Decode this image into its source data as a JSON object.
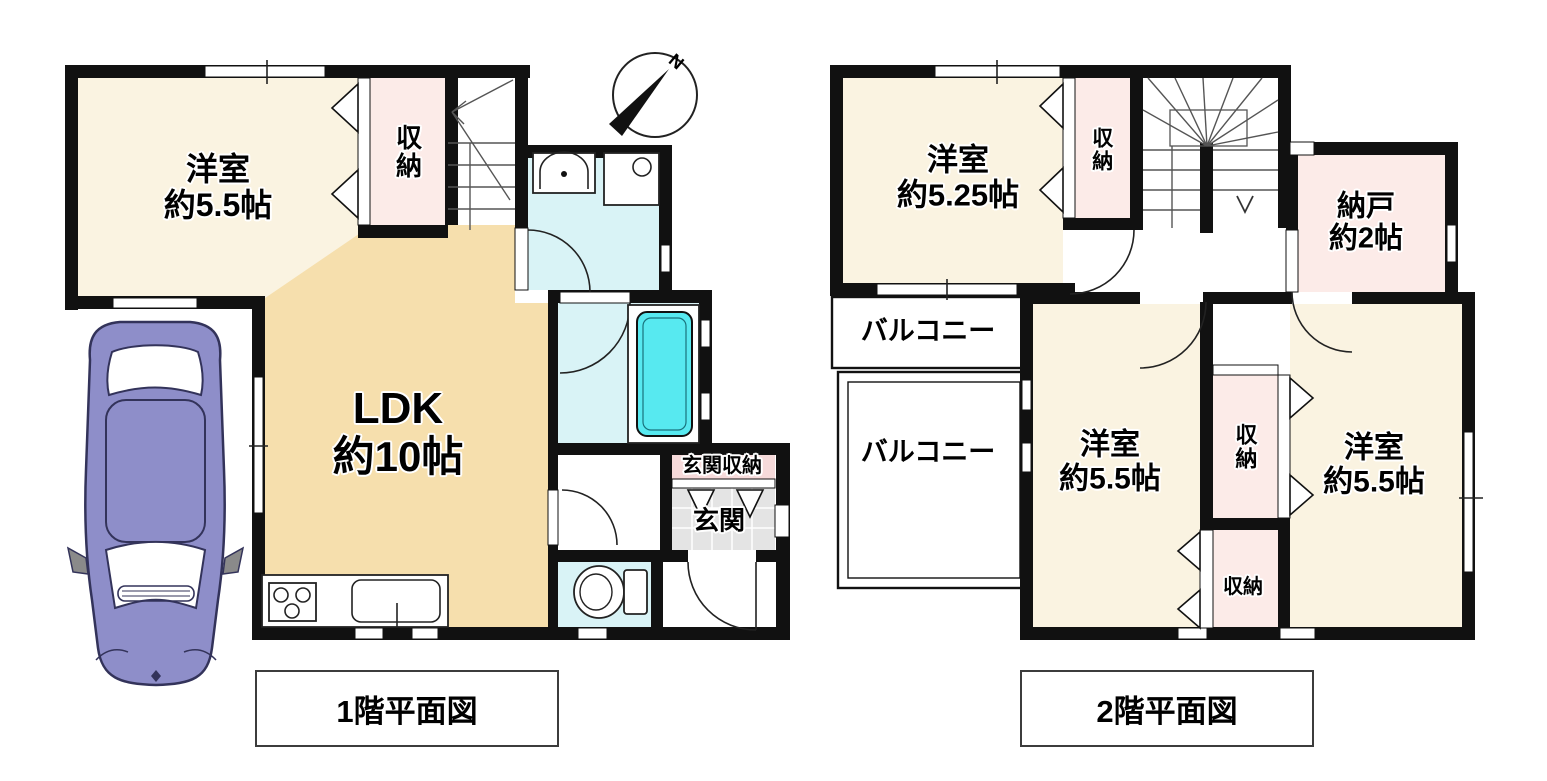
{
  "meta": {
    "type": "floor-plan",
    "width": 1547,
    "height": 781
  },
  "compass": {
    "north_label": "N"
  },
  "floor1": {
    "caption": "1階平面図",
    "rooms": {
      "western_room": {
        "name": "洋室",
        "size": "約5.5帖"
      },
      "ldk": {
        "name": "LDK",
        "size": "約10帖"
      },
      "closet": {
        "label": "収納"
      },
      "entrance_storage": {
        "label": "玄関収納"
      },
      "entrance": {
        "label": "玄関"
      }
    }
  },
  "floor2": {
    "caption": "2階平面図",
    "rooms": {
      "western_room_525": {
        "name": "洋室",
        "size": "約5.25帖"
      },
      "storeroom": {
        "name": "納戸",
        "size": "約2帖"
      },
      "closet_top": {
        "label": "収納"
      },
      "balcony_upper": {
        "label": "バルコニー"
      },
      "balcony_lower": {
        "label": "バルコニー"
      },
      "western_room_sw": {
        "name": "洋室",
        "size": "約5.5帖"
      },
      "western_room_se": {
        "name": "洋室",
        "size": "約5.5帖"
      },
      "closet_mid": {
        "label": "収納"
      },
      "closet_low": {
        "label": "収納"
      }
    }
  },
  "colors": {
    "wall": "#111111",
    "room_cream": "#faf3e1",
    "ldk_tan": "#f6dfad",
    "closet_pink": "#fcebe8",
    "wet_area_cyan": "#d9f3f6",
    "bathtub_cyan": "#57e9f0",
    "entrance_gray": "#e4e4e4",
    "car_purple": "#8e8ec9"
  }
}
